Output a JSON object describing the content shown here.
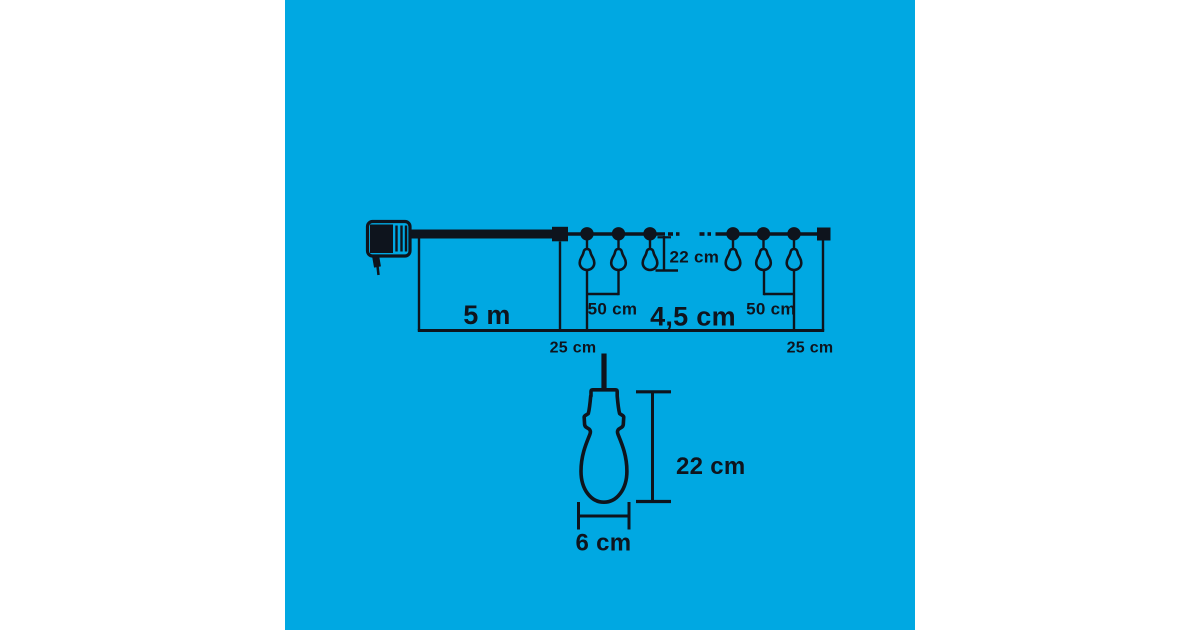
{
  "colors": {
    "margin": "#FFFFFF",
    "canvas": "#00A8E2",
    "ink": "#0E141D"
  },
  "labels": {
    "lead_length": "5 m",
    "offset_left": "25 cm",
    "spacing_left": "50 cm",
    "drop_height": "22 cm",
    "total_length": "4,5 cm",
    "spacing_right": "50 cm",
    "offset_right": "25 cm",
    "detail_height": "22 cm",
    "detail_width": "6 cm"
  }
}
